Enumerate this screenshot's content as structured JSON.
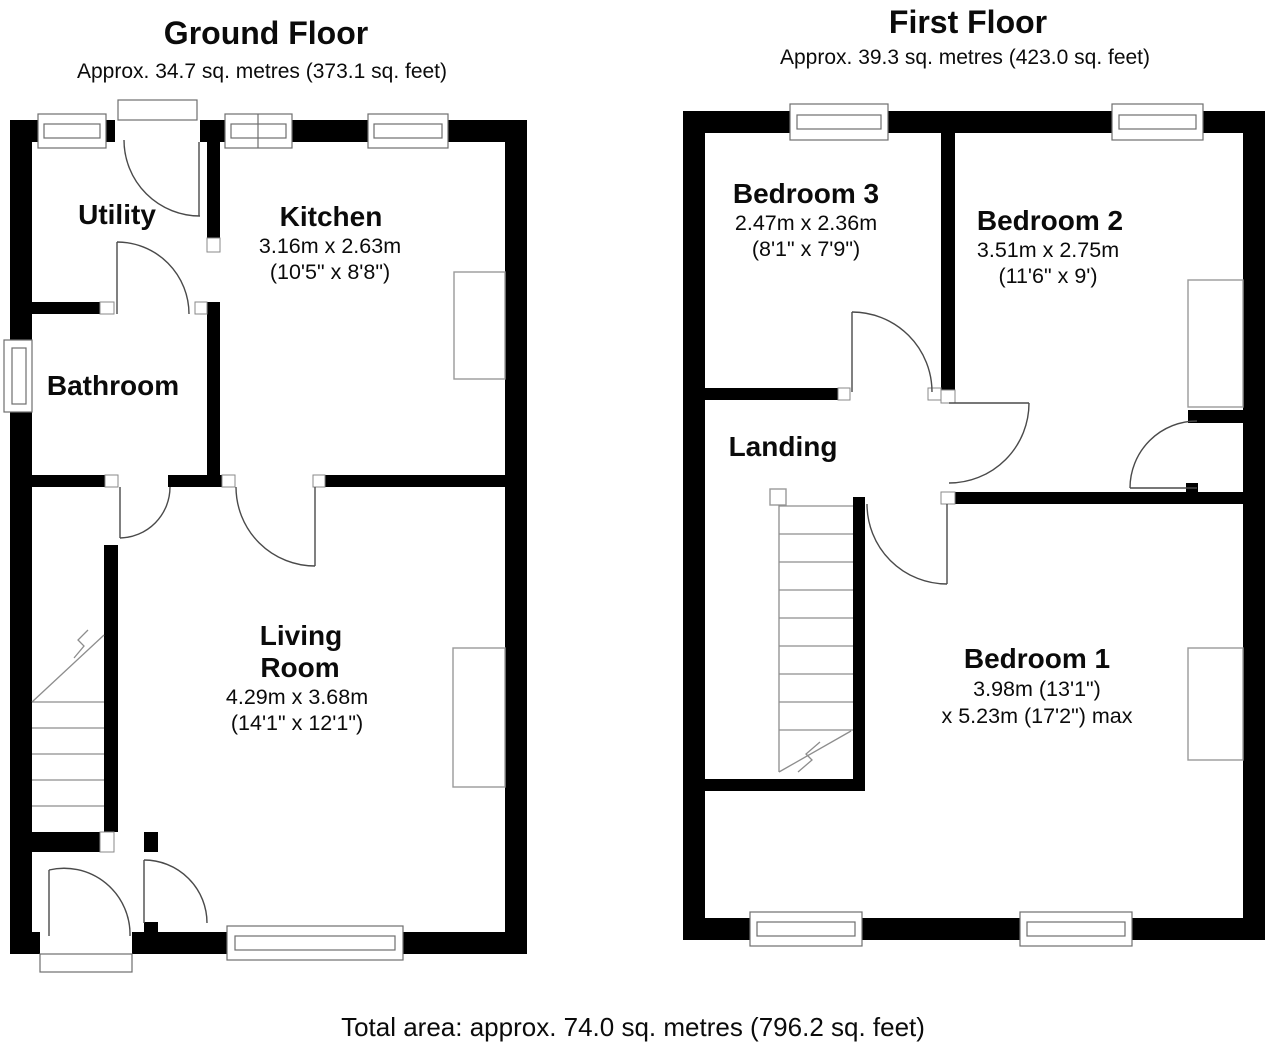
{
  "colors": {
    "background": "#ffffff",
    "wall": "#000000",
    "door_line": "#4a4a4a",
    "furniture_line": "#9a9a9a",
    "text": "#0b0b0b"
  },
  "ground_floor": {
    "title": "Ground Floor",
    "subtitle": "Approx. 34.7 sq. metres (373.1 sq. feet)",
    "rooms": {
      "utility": {
        "name": "Utility"
      },
      "kitchen": {
        "name": "Kitchen",
        "dims_metric": "3.16m x 2.63m",
        "dims_imperial": "(10'5\" x 8'8\")"
      },
      "bathroom": {
        "name": "Bathroom"
      },
      "living_room": {
        "name_line1": "Living",
        "name_line2": "Room",
        "dims_metric": "4.29m x 3.68m",
        "dims_imperial": "(14'1\" x 12'1\")"
      }
    }
  },
  "first_floor": {
    "title": "First Floor",
    "subtitle": "Approx. 39.3 sq. metres (423.0 sq. feet)",
    "rooms": {
      "bedroom3": {
        "name": "Bedroom 3",
        "dims_metric": "2.47m x 2.36m",
        "dims_imperial": "(8'1\" x 7'9\")"
      },
      "bedroom2": {
        "name": "Bedroom 2",
        "dims_metric": "3.51m x 2.75m",
        "dims_imperial": "(11'6\" x 9')"
      },
      "landing": {
        "name": "Landing"
      },
      "bedroom1": {
        "name": "Bedroom 1",
        "dims_line1": "3.98m (13'1\")",
        "dims_line2": "x 5.23m (17'2\") max"
      }
    }
  },
  "footer": {
    "total_area": "Total area: approx. 74.0 sq. metres (796.2 sq. feet)"
  }
}
